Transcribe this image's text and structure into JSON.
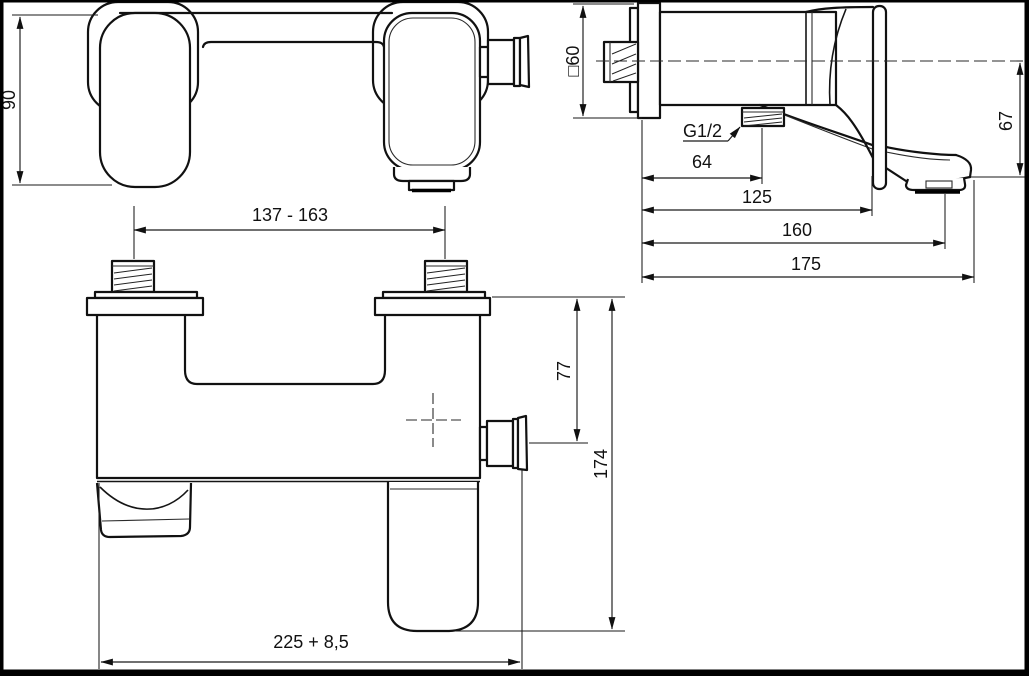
{
  "document": {
    "kind": "technical-dimension-drawing",
    "subject": "wall-mounted bath shower mixer tap, three orthographic views"
  },
  "colors": {
    "background": "#ffffff",
    "line": "#111111",
    "frame": "#000000"
  },
  "dims": {
    "d90": "90",
    "d137_163": "137 - 163",
    "sq60": "□60",
    "g12": "G1/2",
    "d64": "64",
    "d125": "125",
    "d160": "160",
    "d175": "175",
    "d67": "67",
    "d77": "77",
    "d174": "174",
    "d225": "225 + 8,5"
  }
}
